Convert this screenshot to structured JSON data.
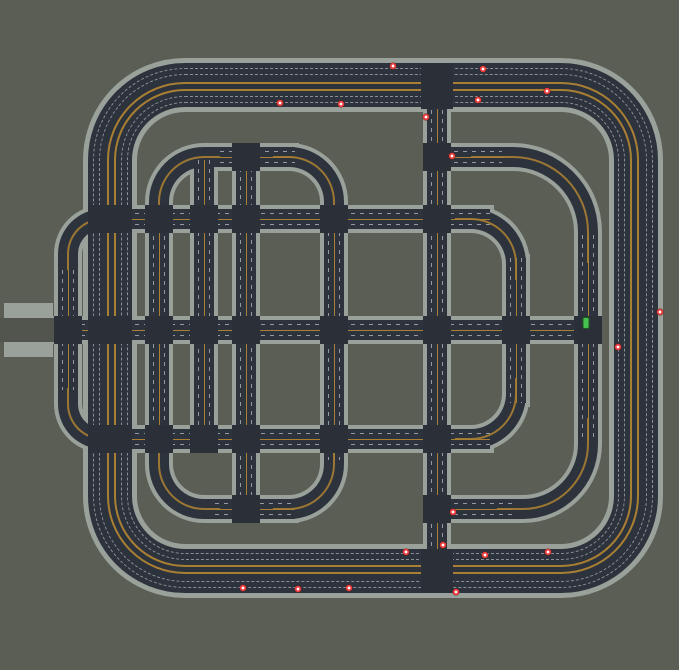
{
  "scene": {
    "description": "Top-down traffic simulation viewport showing a road network with nested ring roads, a city grid and moving vehicles",
    "colors": {
      "background": "#5a5e55",
      "sidewalk": "#9aa19a",
      "asphalt": "#2d333c",
      "junction": "#2a2f38",
      "center_line": "#a97f33",
      "vehicle_red": "#e84040",
      "vehicle_green": "#46c24e",
      "stub_strip": "#51554d"
    }
  },
  "network": {
    "highway_ring": {
      "x": 88,
      "y": 63,
      "w": 570,
      "h": 530,
      "road_width": 44,
      "radius": 97,
      "casing": 5,
      "orange_line_offsets": [
        19,
        26
      ],
      "dash_line_offsets": [
        5,
        11,
        33,
        39
      ]
    },
    "roads": [
      {
        "id": "h1",
        "dir": "h",
        "x": 90,
        "y": 209,
        "w": 400,
        "h": 20
      },
      {
        "id": "h2-middle",
        "dir": "h",
        "x": 54,
        "y": 320,
        "w": 544,
        "h": 20
      },
      {
        "id": "h3",
        "dir": "h",
        "x": 90,
        "y": 429,
        "w": 400,
        "h": 20
      },
      {
        "id": "ring2-top-west",
        "dir": "h",
        "x": 220,
        "y": 147,
        "w": 75,
        "h": 20
      },
      {
        "id": "ring2-top-east",
        "dir": "h",
        "x": 427,
        "y": 147,
        "w": 75,
        "h": 20
      },
      {
        "id": "ring2-bot-west",
        "dir": "h",
        "x": 215,
        "y": 499,
        "w": 80,
        "h": 20
      },
      {
        "id": "ring2-bot-east",
        "dir": "h",
        "x": 427,
        "y": 499,
        "w": 85,
        "h": 20
      },
      {
        "id": "v1-west-bulge",
        "dir": "v",
        "x": 58,
        "y": 270,
        "w": 20,
        "h": 120
      },
      {
        "id": "v2",
        "dir": "v",
        "x": 149,
        "y": 218,
        "w": 20,
        "h": 232
      },
      {
        "id": "v3",
        "dir": "v",
        "x": 194,
        "y": 160,
        "w": 20,
        "h": 289
      },
      {
        "id": "v4",
        "dir": "v",
        "x": 236,
        "y": 150,
        "w": 20,
        "h": 369
      },
      {
        "id": "v5",
        "dir": "v",
        "x": 324,
        "y": 205,
        "w": 20,
        "h": 255
      },
      {
        "id": "v-main",
        "dir": "v",
        "x": 427,
        "y": 65,
        "w": 20,
        "h": 526
      },
      {
        "id": "v6",
        "dir": "v",
        "x": 506,
        "y": 258,
        "w": 20,
        "h": 145
      },
      {
        "id": "v7",
        "dir": "v",
        "x": 578,
        "y": 235,
        "w": 20,
        "h": 205
      }
    ],
    "corners": [
      {
        "id": "v2-top",
        "o": "tl",
        "x": 149,
        "y": 147,
        "w": 80,
        "h": 80,
        "r": 55
      },
      {
        "id": "v5-top",
        "o": "tr",
        "x": 264,
        "y": 147,
        "w": 80,
        "h": 80,
        "r": 55
      },
      {
        "id": "v7-top",
        "o": "tr",
        "x": 462,
        "y": 147,
        "w": 136,
        "h": 125,
        "r": 85
      },
      {
        "id": "v6-top",
        "o": "tr",
        "x": 446,
        "y": 209,
        "w": 80,
        "h": 80,
        "r": 55
      },
      {
        "id": "v1-top",
        "o": "tl",
        "x": 58,
        "y": 209,
        "w": 70,
        "h": 70,
        "r": 45
      },
      {
        "id": "v1-bot",
        "o": "bl",
        "x": 58,
        "y": 379,
        "w": 70,
        "h": 70,
        "r": 45
      },
      {
        "id": "v6-bot",
        "o": "br",
        "x": 446,
        "y": 369,
        "w": 80,
        "h": 80,
        "r": 55
      },
      {
        "id": "v5-bot",
        "o": "br",
        "x": 264,
        "y": 439,
        "w": 80,
        "h": 80,
        "r": 55
      },
      {
        "id": "v2-bot",
        "o": "bl",
        "x": 149,
        "y": 441,
        "w": 80,
        "h": 78,
        "r": 55
      },
      {
        "id": "v7-bot",
        "o": "br",
        "x": 488,
        "y": 409,
        "w": 110,
        "h": 110,
        "r": 75
      }
    ],
    "junctions": [
      {
        "x": 421,
        "y": 63,
        "w": 32,
        "h": 46
      },
      {
        "x": 421,
        "y": 549,
        "w": 32,
        "h": 44
      },
      {
        "x": 88,
        "y": 205,
        "w": 44,
        "h": 28
      },
      {
        "x": 88,
        "y": 316,
        "w": 44,
        "h": 28
      },
      {
        "x": 88,
        "y": 425,
        "w": 44,
        "h": 28
      },
      {
        "x": 54,
        "y": 316,
        "w": 28,
        "h": 28
      },
      {
        "x": 145,
        "y": 205,
        "w": 28,
        "h": 28
      },
      {
        "x": 145,
        "y": 316,
        "w": 28,
        "h": 28
      },
      {
        "x": 145,
        "y": 425,
        "w": 28,
        "h": 28
      },
      {
        "x": 190,
        "y": 205,
        "w": 28,
        "h": 28
      },
      {
        "x": 190,
        "y": 316,
        "w": 28,
        "h": 28
      },
      {
        "x": 190,
        "y": 425,
        "w": 28,
        "h": 28
      },
      {
        "x": 232,
        "y": 143,
        "w": 28,
        "h": 28
      },
      {
        "x": 232,
        "y": 205,
        "w": 28,
        "h": 28
      },
      {
        "x": 232,
        "y": 316,
        "w": 28,
        "h": 28
      },
      {
        "x": 232,
        "y": 425,
        "w": 28,
        "h": 28
      },
      {
        "x": 232,
        "y": 495,
        "w": 28,
        "h": 28
      },
      {
        "x": 320,
        "y": 205,
        "w": 28,
        "h": 28
      },
      {
        "x": 320,
        "y": 316,
        "w": 28,
        "h": 28
      },
      {
        "x": 320,
        "y": 425,
        "w": 28,
        "h": 28
      },
      {
        "x": 423,
        "y": 143,
        "w": 28,
        "h": 28
      },
      {
        "x": 423,
        "y": 205,
        "w": 28,
        "h": 28
      },
      {
        "x": 423,
        "y": 316,
        "w": 28,
        "h": 28
      },
      {
        "x": 423,
        "y": 425,
        "w": 28,
        "h": 28
      },
      {
        "x": 423,
        "y": 495,
        "w": 28,
        "h": 28
      },
      {
        "x": 502,
        "y": 316,
        "w": 28,
        "h": 28
      },
      {
        "x": 574,
        "y": 316,
        "w": 28,
        "h": 28
      }
    ],
    "west_stub": {
      "bars": [
        {
          "x": 4,
          "y": 303,
          "w": 49,
          "h": 15
        },
        {
          "x": 4,
          "y": 342,
          "w": 49,
          "h": 15
        }
      ],
      "strip": {
        "x": 0,
        "y": 318,
        "w": 56,
        "h": 24
      }
    }
  },
  "vehicles": {
    "red_cars": [
      {
        "x": 393,
        "y": 66
      },
      {
        "x": 483,
        "y": 69
      },
      {
        "x": 280,
        "y": 103
      },
      {
        "x": 341,
        "y": 104
      },
      {
        "x": 478,
        "y": 100
      },
      {
        "x": 547,
        "y": 91
      },
      {
        "x": 426,
        "y": 117
      },
      {
        "x": 452,
        "y": 156
      },
      {
        "x": 660,
        "y": 312
      },
      {
        "x": 618,
        "y": 347
      },
      {
        "x": 453,
        "y": 512
      },
      {
        "x": 443,
        "y": 545
      },
      {
        "x": 406,
        "y": 552
      },
      {
        "x": 485,
        "y": 555
      },
      {
        "x": 548,
        "y": 552
      },
      {
        "x": 243,
        "y": 588
      },
      {
        "x": 298,
        "y": 589
      },
      {
        "x": 349,
        "y": 588
      },
      {
        "x": 456,
        "y": 592
      }
    ],
    "green_car": {
      "x": 586,
      "y": 323
    }
  }
}
